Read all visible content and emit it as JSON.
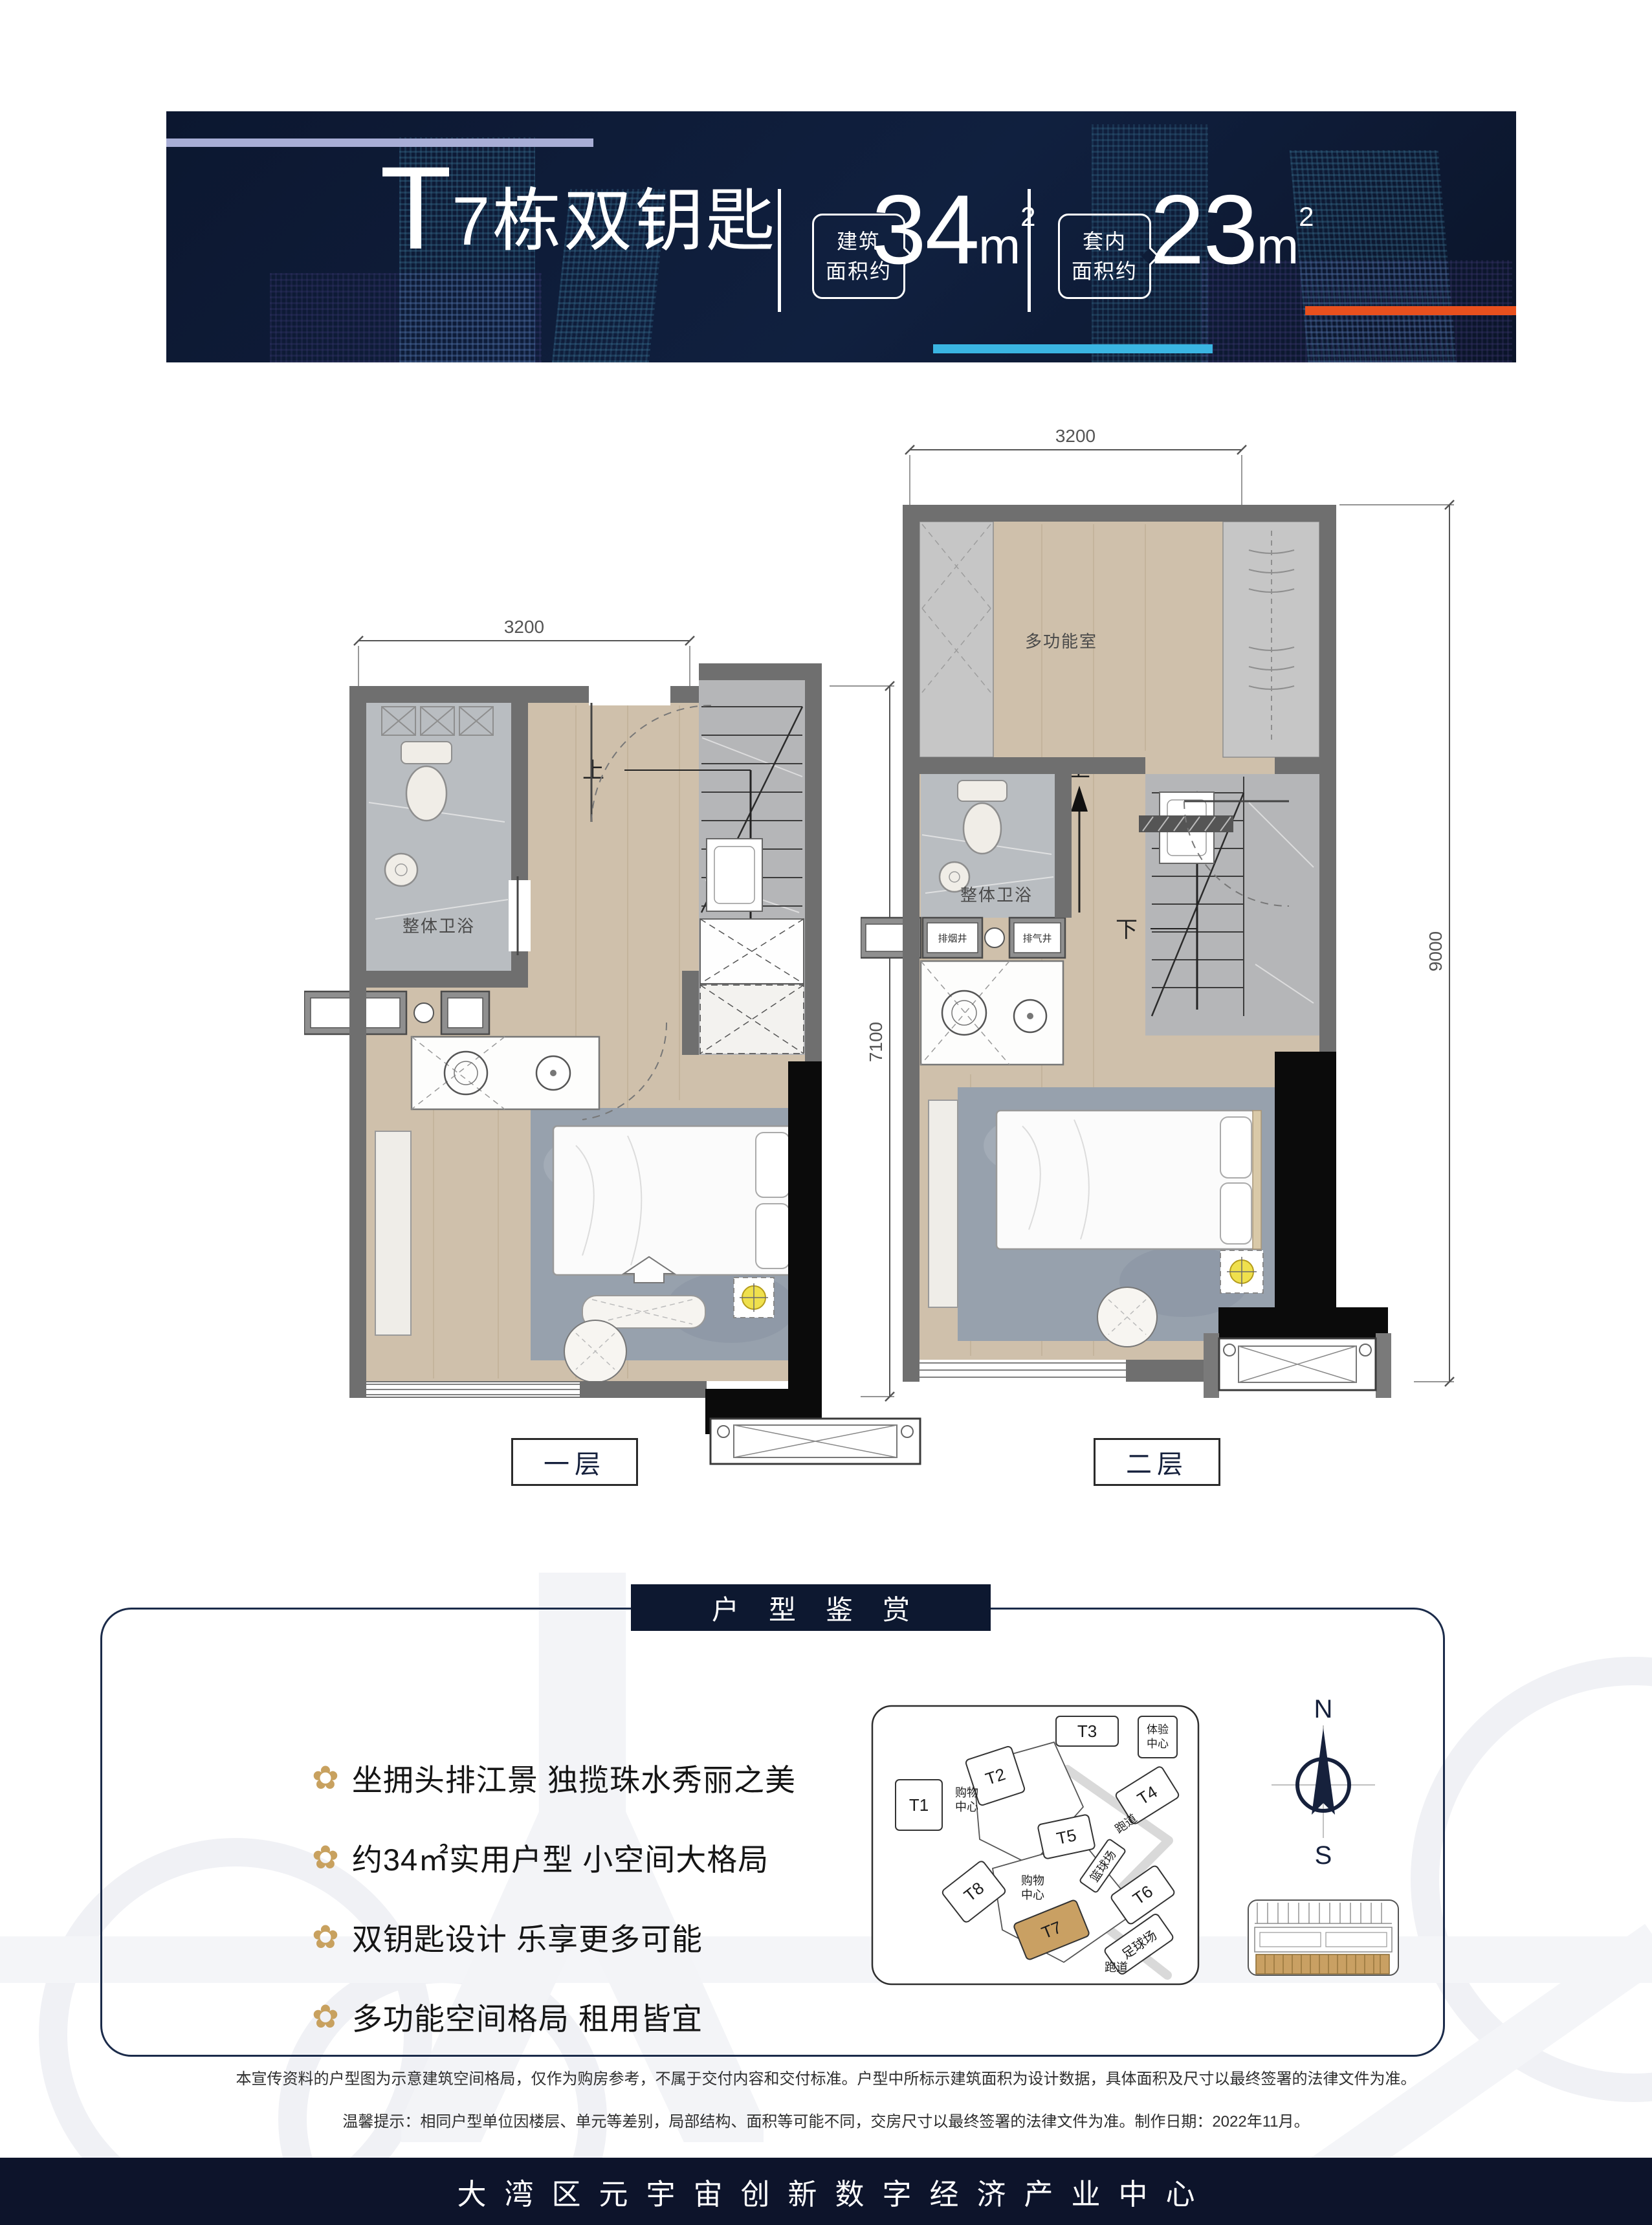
{
  "banner": {
    "background_color": "#0e1c37",
    "accent_line_color": "#a8aed6",
    "title_t": "T",
    "title_rest": "7栋双钥匙",
    "metrics": [
      {
        "label_line1": "建筑",
        "label_line2": "面积约",
        "value": "34",
        "unit": "m",
        "sup": "2",
        "underline_color": "#3ab5e2"
      },
      {
        "label_line1": "套内",
        "label_line2": "面积约",
        "value": "23",
        "unit": "m",
        "sup": "2",
        "underline_color": "#e8501e"
      }
    ]
  },
  "plans": {
    "floor1": {
      "label": "一层",
      "dim_width": "3200",
      "dim_height": "7100",
      "bathroom": "整体卫浴",
      "stairs_up": "上"
    },
    "floor2": {
      "label": "二层",
      "dim_width": "3200",
      "dim_height": "9000",
      "room": "多功能室",
      "bathroom": "整体卫浴",
      "stairs_up": "上",
      "stairs_down": "下",
      "shaft_smoke": "排烟井",
      "shaft_air": "排气井"
    }
  },
  "appreciation": {
    "title": "户型鉴赏",
    "bullet_icon": "✿",
    "accent_color": "#c8a15f",
    "bullets": [
      "坐拥头排江景 独揽珠水秀丽之美",
      "约34㎡实用户型 小空间大格局",
      "双钥匙设计 乐享更多可能",
      "多功能空间格局 租用皆宜"
    ]
  },
  "sitemap": {
    "t1": "T1",
    "t2": "T2",
    "t3": "T3",
    "t4": "T4",
    "t5": "T5",
    "t6": "T6",
    "t7": "T7",
    "t8": "T8",
    "experience_line1": "体验",
    "experience_line2": "中心",
    "mall_line1": "购物",
    "mall_line2": "中心",
    "track": "跑道",
    "basketball": "篮球场",
    "football": "足球场",
    "highlight_color": "#c9a063"
  },
  "compass": {
    "north": "N",
    "south": "S"
  },
  "disclaimer": {
    "line1": "本宣传资料的户型图为示意建筑空间格局，仅作为购房参考，不属于交付内容和交付标准。户型中所标示建筑面积为设计数据，具体面积及尺寸以最终签署的法律文件为准。",
    "line2": "温馨提示：相同户型单位因楼层、单元等差别，局部结构、面积等可能不同，交房尺寸以最终签署的法律文件为准。制作日期：2022年11月。"
  },
  "footer": {
    "text": "大湾区元宇宙创新数字经济产业中心"
  }
}
